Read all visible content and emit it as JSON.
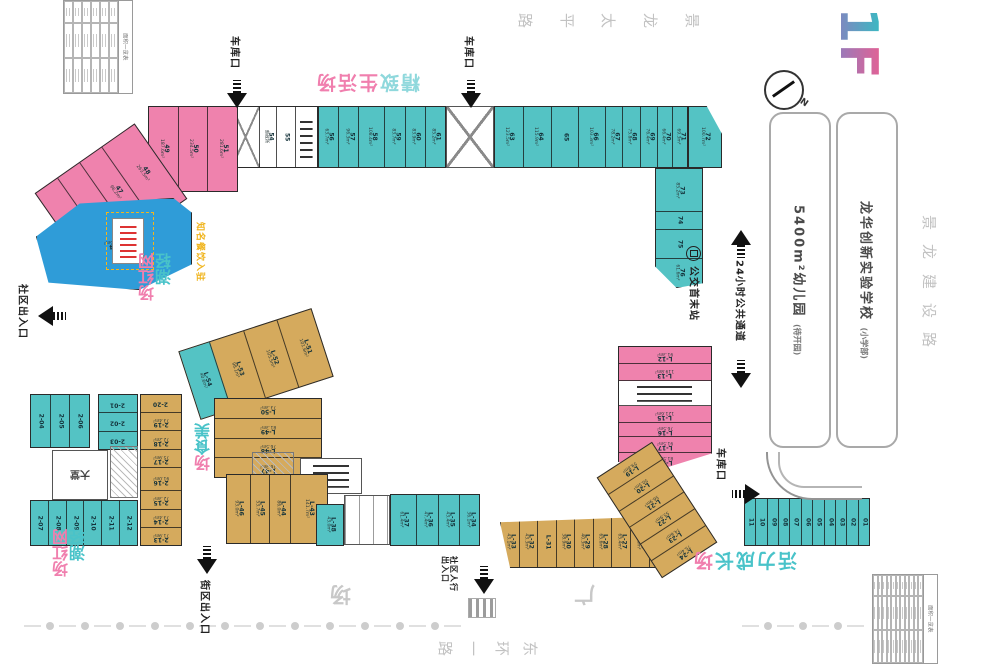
{
  "logo": {
    "first": "1",
    "second": "F",
    "teal": "#35bdc2",
    "pink": "#e85f92"
  },
  "compass": {
    "label": "N"
  },
  "roads": {
    "top": [
      "路",
      "平",
      "太",
      "龙",
      "景"
    ],
    "right": [
      "景",
      "龙",
      "建",
      "设",
      "路"
    ],
    "bottom": [
      "路",
      "一",
      "环",
      "东"
    ]
  },
  "plaza": {
    "char1": "广",
    "char2": "场"
  },
  "blocks": {
    "kindergarten": {
      "name": "5400m²幼儿园",
      "sub": "(待开园)"
    },
    "school": {
      "name": "龙华创新实验学校",
      "sub": "(小学部)"
    }
  },
  "features": {
    "parking": "车库口",
    "bus_station": "公交首末站",
    "passage_24h": "24小时公共通道",
    "community_exit": "社区出入口",
    "street_exit": "街区出入口",
    "pedestrian_exit_l1": "社区人行",
    "pedestrian_exit_l2": "出入口",
    "lobby": "大堂",
    "restaurant_note": "知名餐饮入驻"
  },
  "area_labels": {
    "jingzhi": {
      "mode": "h",
      "segments": [
        {
          "t": "精致",
          "c": "#8fd8dc"
        },
        {
          "t": "生活场",
          "c": "#f07fae"
        }
      ]
    },
    "qingchao1": {
      "mode": "v2",
      "lines": [
        {
          "t": "轻潮",
          "c": "#49c3c9"
        },
        {
          "t": "网红场",
          "c": "#f07fae"
        }
      ]
    },
    "qingchao2": {
      "mode": "v2",
      "lines": [
        {
          "t": "轻潮",
          "c": "#49c3c9"
        },
        {
          "t": "网红场",
          "c": "#f07fae"
        }
      ]
    },
    "meishi": {
      "mode": "v1",
      "segments": [
        {
          "t": "美食",
          "c": "#49c3c9"
        },
        {
          "t": "场",
          "c": "#f07fae"
        }
      ]
    },
    "huoli": {
      "mode": "h",
      "segments": [
        {
          "t": "活力成长",
          "c": "#49c3c9"
        },
        {
          "t": "场",
          "c": "#f07fae"
        }
      ]
    }
  },
  "tables": {
    "top_left": {
      "title": "面积一览表",
      "cols": 6,
      "rows": 3
    },
    "bottom_right": {
      "title": "面积一览表",
      "cols": 11,
      "rows": 3
    }
  },
  "clusters": {
    "strip_a": {
      "color": "#ffffff",
      "units": [
        {
          "i": "52",
          "a": "71.2m²",
          "c": "#ef82ad",
          "f": 1.2
        },
        {
          "i": "53",
          "a": "警务室",
          "f": 0.9
        },
        {
          "i": "",
          "ramp": true,
          "f": 1.8
        },
        {
          "i": "54",
          "a": "邮政所",
          "f": 1.1
        },
        {
          "i": "55",
          "a": "",
          "f": 1.2
        },
        {
          "i": "",
          "elev": true,
          "f": 1.4
        }
      ]
    },
    "strip_b": {
      "color": "#54c3c4",
      "units": [
        {
          "i": "56",
          "a": "63.7m²"
        },
        {
          "i": "57",
          "a": "96.3m²"
        },
        {
          "i": "58",
          "a": "108.4m²",
          "f": 1.3
        },
        {
          "i": "59",
          "a": "83.7m²"
        },
        {
          "i": "60",
          "a": "83.9m²"
        },
        {
          "i": "61",
          "a": "85.2m²"
        }
      ]
    },
    "strip_c": {
      "color": "#54c3c4",
      "units": [
        {
          "i": "63",
          "a": "123.5m²",
          "f": 1.5
        },
        {
          "i": "64",
          "a": "115.9m²",
          "f": 1.5
        },
        {
          "i": "65",
          "a": "",
          "f": 1.4
        },
        {
          "i": "66",
          "a": "103.3m²",
          "f": 1.4
        },
        {
          "i": "67",
          "a": "78.2m²",
          "f": 0.85
        },
        {
          "i": "68",
          "a": "75.8m²",
          "f": 0.9
        },
        {
          "i": "69",
          "a": "76.4m²",
          "f": 0.9
        },
        {
          "i": "70",
          "a": "66.4m²",
          "f": 0.75
        },
        {
          "i": "71",
          "a": "69.3m²",
          "f": 0.75
        }
      ]
    },
    "unit72": {
      "color": "#54c3c4",
      "units": [
        {
          "i": "72",
          "a": "100.7m²"
        }
      ]
    },
    "teal_col": {
      "color": "#54c3c4",
      "units": [
        {
          "i": "73",
          "a": "85.2m²",
          "f": 1.5
        },
        {
          "i": "74",
          "a": "",
          "f": 0.6
        },
        {
          "i": "75",
          "a": "",
          "f": 1
        },
        {
          "i": "76",
          "a": "61.6m²",
          "f": 1
        }
      ]
    },
    "pink_a": {
      "color": "#ef82ad",
      "units": [
        {
          "i": "49",
          "a": "187.6m²"
        },
        {
          "i": "50",
          "a": "234.5m²"
        },
        {
          "i": "51",
          "a": "281.6m²"
        }
      ]
    },
    "pink_b": {
      "color": "#ef82ad",
      "units": [
        {
          "i": "45",
          "a": ""
        },
        {
          "i": "46",
          "a": ""
        },
        {
          "i": "47",
          "a": "96.2m²"
        },
        {
          "i": "48",
          "a": "263.5m²",
          "f": 1.5
        }
      ]
    },
    "blue44": {
      "color": "#2f9cd8",
      "units": [
        {
          "i": "44",
          "a": "243.5m²"
        }
      ]
    },
    "pink_r": {
      "color": "#ef82ad",
      "units": [
        {
          "i": "L-12",
          "a": "91.3m²"
        },
        {
          "i": "L-13",
          "a": "119.8m²"
        },
        {
          "i": "",
          "elev": true,
          "f": 1.5
        },
        {
          "i": "L-15",
          "a": "121.6m²"
        },
        {
          "i": "L-16",
          "a": "76.5m²",
          "f": 0.8
        },
        {
          "i": "L-17",
          "a": "91.5m²",
          "f": 0.9
        },
        {
          "i": "L-18",
          "a": "81.5m²",
          "f": 0.9
        }
      ]
    },
    "tan_a": {
      "color": "#d5aa5d",
      "units": [
        {
          "i": "L-54",
          "a": "40.6m²",
          "c": "#54c3c4",
          "f": 0.9
        },
        {
          "i": "L-53",
          "a": "98.1m²"
        },
        {
          "i": "L-52",
          "a": "105.5m²"
        },
        {
          "i": "L-51",
          "a": "101.6m²"
        }
      ]
    },
    "tan_b": {
      "color": "#d5aa5d",
      "units": [
        {
          "i": "L-50",
          "a": "73.3m²"
        },
        {
          "i": "L-49",
          "a": "81.3m²"
        },
        {
          "i": "L-48",
          "a": "76.5m²"
        },
        {
          "i": "L-47",
          "a": "76.3m²"
        }
      ]
    },
    "teal_a1": {
      "color": "#54c3c4",
      "units": [
        {
          "i": "2-04",
          "a": ""
        },
        {
          "i": "2-05",
          "a": ""
        },
        {
          "i": "2-06",
          "a": ""
        }
      ]
    },
    "teal_a2": {
      "color": "#54c3c4",
      "units": [
        {
          "i": "2-01",
          "a": ""
        },
        {
          "i": "2-02",
          "a": ""
        },
        {
          "i": "2-03",
          "a": ""
        }
      ]
    },
    "teal_b": {
      "color": "#54c3c4",
      "units": [
        {
          "i": "2-07",
          "a": ""
        },
        {
          "i": "2-08",
          "a": ""
        },
        {
          "i": "2-09",
          "a": ""
        },
        {
          "i": "2-10",
          "a": ""
        },
        {
          "i": "2-11",
          "a": ""
        },
        {
          "i": "2-12",
          "a": ""
        }
      ]
    },
    "tan_c": {
      "color": "#d5aa5d",
      "units": [
        {
          "i": "2-20",
          "a": ""
        },
        {
          "i": "2-19",
          "a": "73.4m²"
        },
        {
          "i": "2-18",
          "a": "72.2m²"
        },
        {
          "i": "2-17",
          "a": "75.9m²"
        },
        {
          "i": "2-16",
          "a": "91.0m²",
          "f": 1.3
        },
        {
          "i": "2-15",
          "a": "72.3m²"
        },
        {
          "i": "2-14",
          "a": "73.4m²"
        },
        {
          "i": "2-13",
          "a": "71.9m²"
        }
      ]
    },
    "tan_d": {
      "color": "#d5aa5d",
      "units": [
        {
          "i": "L-46",
          "a": "93.0m²"
        },
        {
          "i": "L-45",
          "a": "53.7m²",
          "f": 0.8
        },
        {
          "i": "L-44",
          "a": "86.0m²",
          "f": 0.9
        },
        {
          "i": "L-43",
          "a": "141.7m²",
          "f": 1.6
        }
      ]
    },
    "teal_c": {
      "color": "#54c3c4",
      "units": [
        {
          "i": "L-38",
          "a": "43.0m²"
        }
      ]
    },
    "teal_d": {
      "color": "#54c3c4",
      "units": [
        {
          "i": "L-37",
          "a": "61.4m²",
          "f": 1.2
        },
        {
          "i": "L-36",
          "a": "47.4m²"
        },
        {
          "i": "L-35",
          "a": "43.4m²"
        },
        {
          "i": "L-34",
          "a": "36.1m²",
          "f": 0.9
        }
      ]
    },
    "tan_e": {
      "color": "#d5aa5d",
      "units": [
        {
          "i": "L-33",
          "a": "43.1m²"
        },
        {
          "i": "L-32",
          "a": "43.3m²"
        },
        {
          "i": "L-31",
          "a": ""
        },
        {
          "i": "L-30",
          "a": "38.9m²"
        },
        {
          "i": "L-29",
          "a": "40.3m²"
        },
        {
          "i": "L-28",
          "a": "65.6m²"
        },
        {
          "i": "L-27",
          "a": "65.4m²"
        },
        {
          "i": "L-26",
          "a": "38.6m²"
        },
        {
          "i": "L-25",
          "a": "49.8m²"
        }
      ]
    },
    "tan_f": {
      "color": "#d5aa5d",
      "units": [
        {
          "i": "L-19",
          "a": "59.8m²"
        },
        {
          "i": "L-20",
          "a": "50.5m²"
        },
        {
          "i": "L-21",
          "a": "56.9m²"
        },
        {
          "i": "L-22",
          "a": "55.9m²"
        },
        {
          "i": "L-23",
          "a": "74.6m²"
        },
        {
          "i": "L-24",
          "a": "75.4m²"
        }
      ]
    },
    "teal_e": {
      "color": "#54c3c4",
      "units": [
        {
          "i": "11",
          "a": ""
        },
        {
          "i": "10",
          "a": ""
        },
        {
          "i": "09",
          "a": ""
        },
        {
          "i": "08",
          "a": ""
        },
        {
          "i": "07",
          "a": ""
        },
        {
          "i": "06",
          "a": ""
        },
        {
          "i": "05",
          "a": ""
        },
        {
          "i": "04",
          "a": ""
        },
        {
          "i": "03",
          "a": ""
        },
        {
          "i": "02",
          "a": ""
        },
        {
          "i": "01",
          "a": ""
        }
      ]
    }
  }
}
